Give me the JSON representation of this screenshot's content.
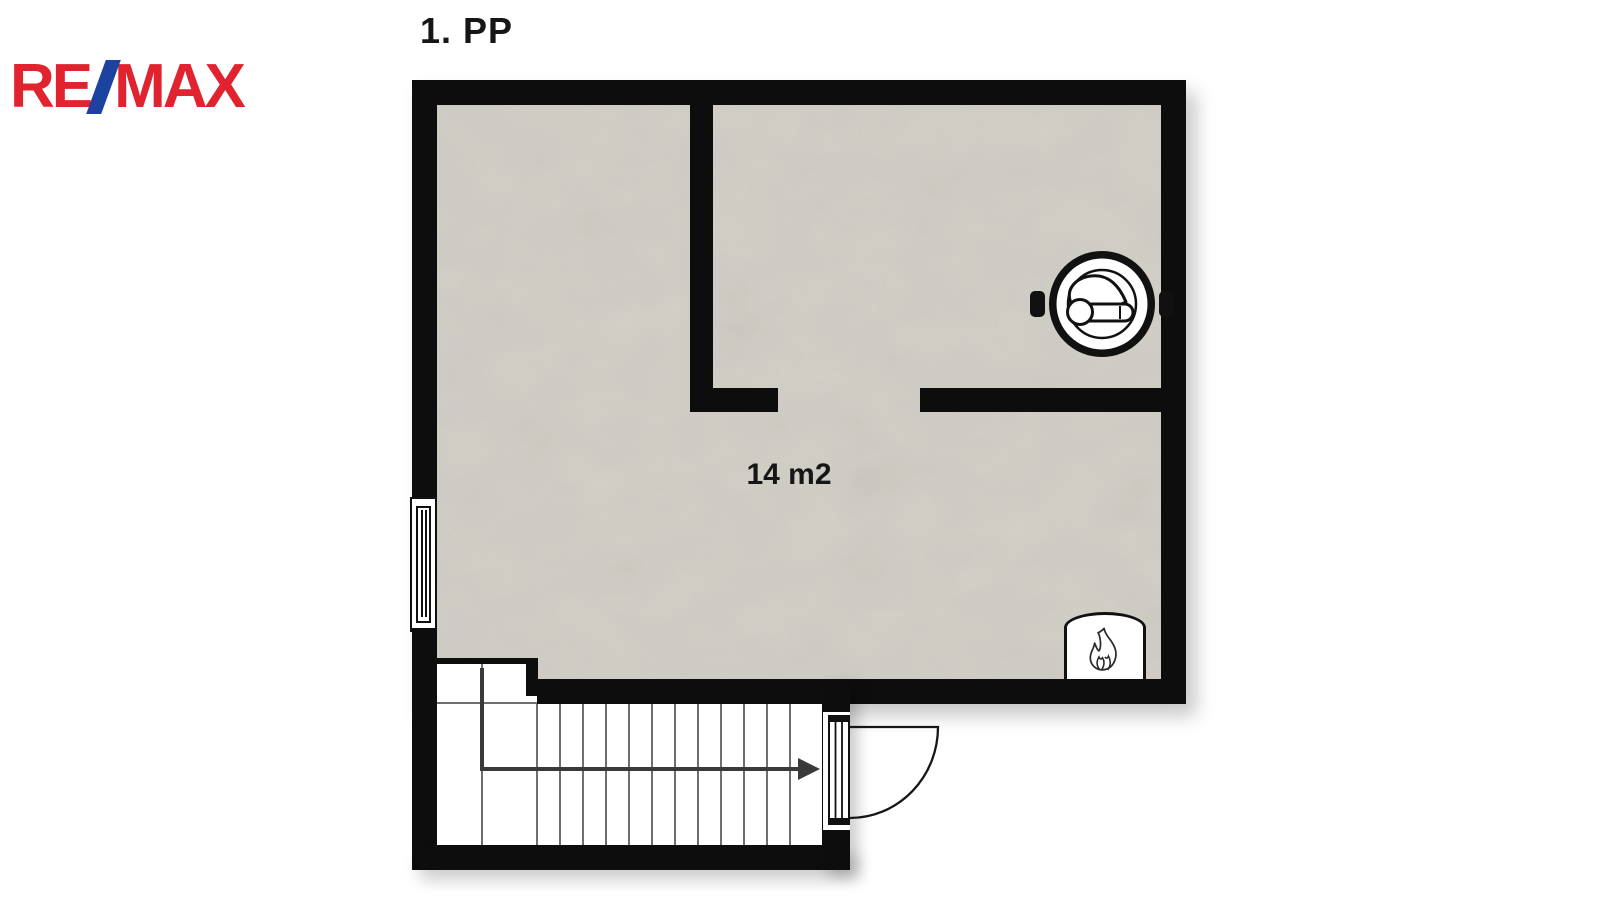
{
  "header": {
    "title": "1. PP"
  },
  "logo": {
    "part_re": "RE",
    "part_slash": "/",
    "part_max": "MAX",
    "color_red": "#e0232e",
    "color_blue": "#1b429f"
  },
  "plan": {
    "area_label": "14 m2",
    "colors": {
      "wall": "#0d0d0d",
      "floor": "#d6d3cb",
      "stair_grid_line": "#6e6e6e",
      "direction_arrow": "#3a3a3a",
      "interior_white": "#ffffff"
    },
    "icons": {
      "boiler": "boiler-icon",
      "flame": "flame-icon",
      "stairs_direction": "stairs-direction-arrow",
      "door": "door-swing-symbol",
      "window": "window-symbol"
    }
  }
}
